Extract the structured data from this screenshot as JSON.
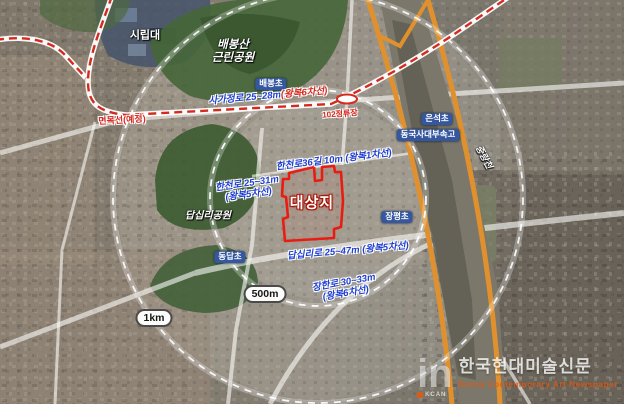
{
  "map": {
    "places": {
      "university": "시립대",
      "mountain_park_line1": "배봉산",
      "mountain_park_line2": "근린공원",
      "park": "답십리공원",
      "river": "중랑천",
      "site": "대상지"
    },
    "schools": [
      "배봉초",
      "은석초",
      "동국사대부속고",
      "장평초",
      "동답초"
    ],
    "transit": {
      "line": "면목선(예정)",
      "station": "102정류장"
    },
    "roads": [
      {
        "name": "사가정로 25~28m",
        "lanes": "(왕복6차선)"
      },
      {
        "name": "한천로36길 10m (왕복1차선)",
        "lanes": ""
      },
      {
        "name": "한천로 25~31m",
        "lanes": "(왕복5차선)"
      },
      {
        "name": "답십리로 25~47m (왕복5차선)",
        "lanes": ""
      },
      {
        "name": "장한로 30~33m",
        "lanes": "(왕복6차선)"
      }
    ],
    "radii": {
      "inner": "500m",
      "outer": "1km"
    },
    "colors": {
      "site_boundary": "#ea1c12",
      "rail_dash": "#d42b20",
      "expressway": "#e0912d",
      "road_label_blue": "#1d3ed1",
      "school_pill": "#35579f"
    }
  },
  "watermark": {
    "logo": "in",
    "logo_sub": "KCAN",
    "title": "한국현대미술신문",
    "subtitle": "Korea Contemporary Art Newspaper"
  }
}
